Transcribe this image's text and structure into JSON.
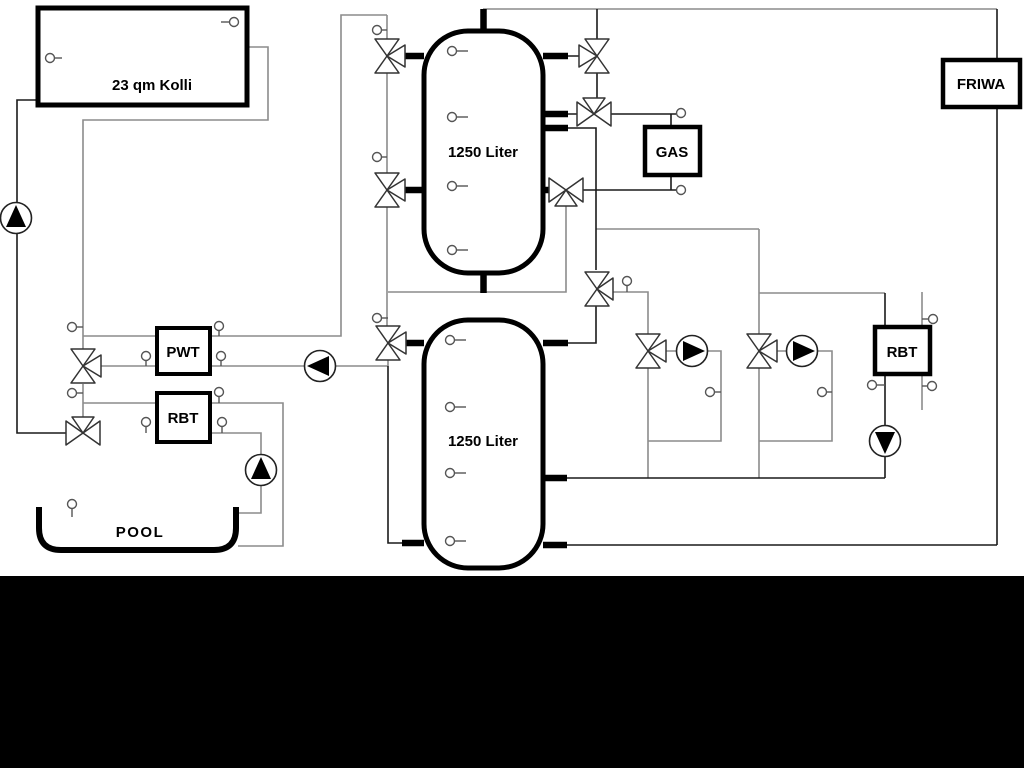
{
  "diagram": {
    "type": "hydraulic-schematic",
    "components": {
      "collector": "23 qm Kolli",
      "tank_upper": "1250 Liter",
      "tank_lower": "1250 Liter",
      "pwt": "PWT",
      "rbt_pool": "RBT",
      "gas": "GAS",
      "rbt_right": "RBT",
      "friwa": "FRIWA",
      "pool": "POOL"
    },
    "colors": {
      "pipe_gray": "#8c8c8c",
      "pipe_dark": "#1a1a1a",
      "component_outline": "#000000",
      "background": "#ffffff",
      "footer_band": "#000000"
    }
  }
}
